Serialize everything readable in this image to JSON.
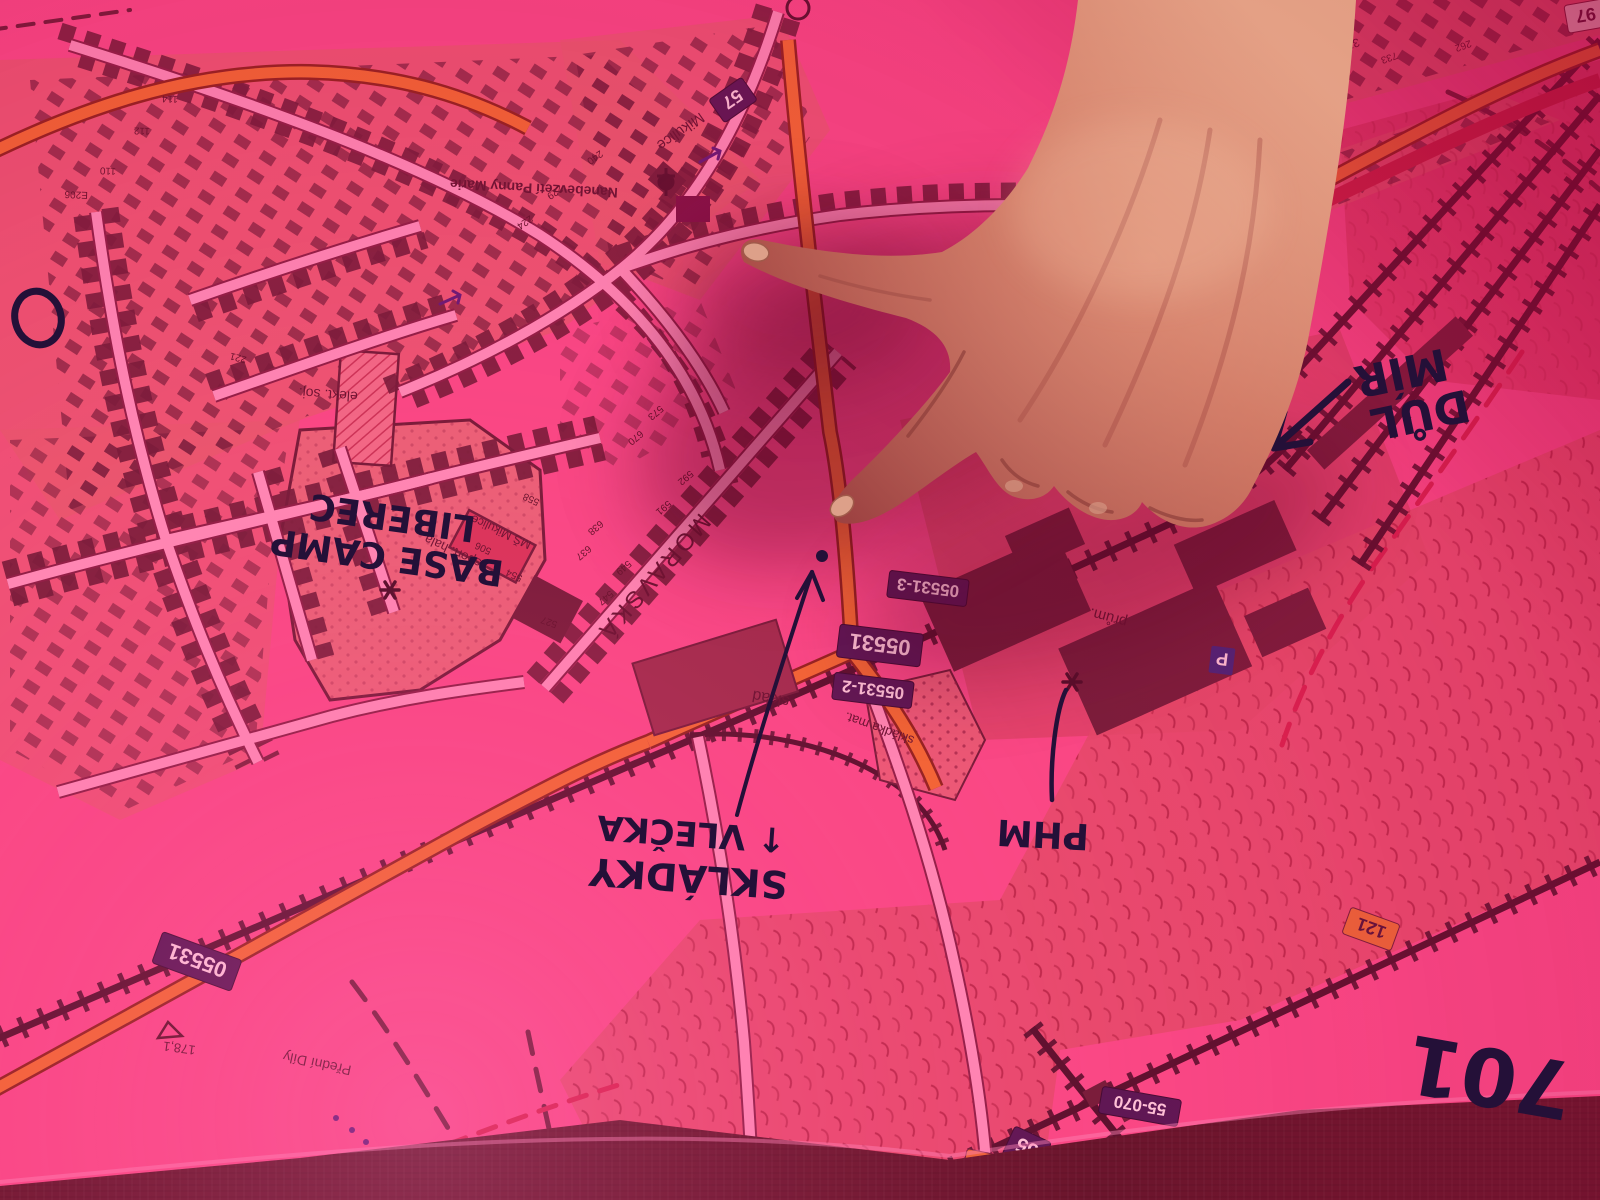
{
  "colors": {
    "map_pink": "#f9538d",
    "urban_salmon": "#e4666f",
    "building_dark": "#5c1d31",
    "road_light": "#ff9fc6",
    "road_orange": "#f0762a",
    "railway_dark": "#3a0f22",
    "field_crimson": "#d84a66",
    "badge_purple": "#3a1650",
    "badge_text": "#ffe9f2",
    "marker_ink": "#241038",
    "hand_skin": "#c86a58",
    "table_band": "#49141f"
  },
  "annotations": {
    "base_camp": {
      "line1": "BASE CAMP",
      "line2": "LIBEREC"
    },
    "dul_mir": {
      "line1": "DŮL",
      "line2": "MÍR"
    },
    "phm": {
      "label": "PHM"
    },
    "skladky": {
      "line1": "SKLÁDKY",
      "line2": "↑ VLEČKA"
    },
    "number_701": {
      "label": "701"
    }
  },
  "map_labels": {
    "mikulice": "Mikulice",
    "church": "Nanebevzetí Panny Marie",
    "moravska": "MORAVSKÁ",
    "sport_hala": "sport. hala",
    "ms_mikulice": "MŠ Mikulice",
    "elekt": "elekt. soj.",
    "sklad": "sklad",
    "skladka_mat": "skládka mat.",
    "prum": "prům.",
    "predni_dily": "Přední Díly",
    "elevation_178": "178,1",
    "spot_370": "370"
  },
  "road_badges": {
    "b05531": "05531",
    "b05531_2": "05531-2",
    "b05531_3": "05531-3",
    "b57": "57",
    "b97": "97",
    "b121": "121",
    "b55": "55",
    "b55_070": "55-070",
    "b120_8": "120,8",
    "parking": "P"
  },
  "house_numbers": [
    "506",
    "554",
    "527",
    "558",
    "221",
    "E206",
    "110",
    "112",
    "114",
    "592",
    "591",
    "549",
    "547",
    "638",
    "637",
    "670",
    "573",
    "240",
    "229",
    "224",
    "733",
    "262"
  ]
}
